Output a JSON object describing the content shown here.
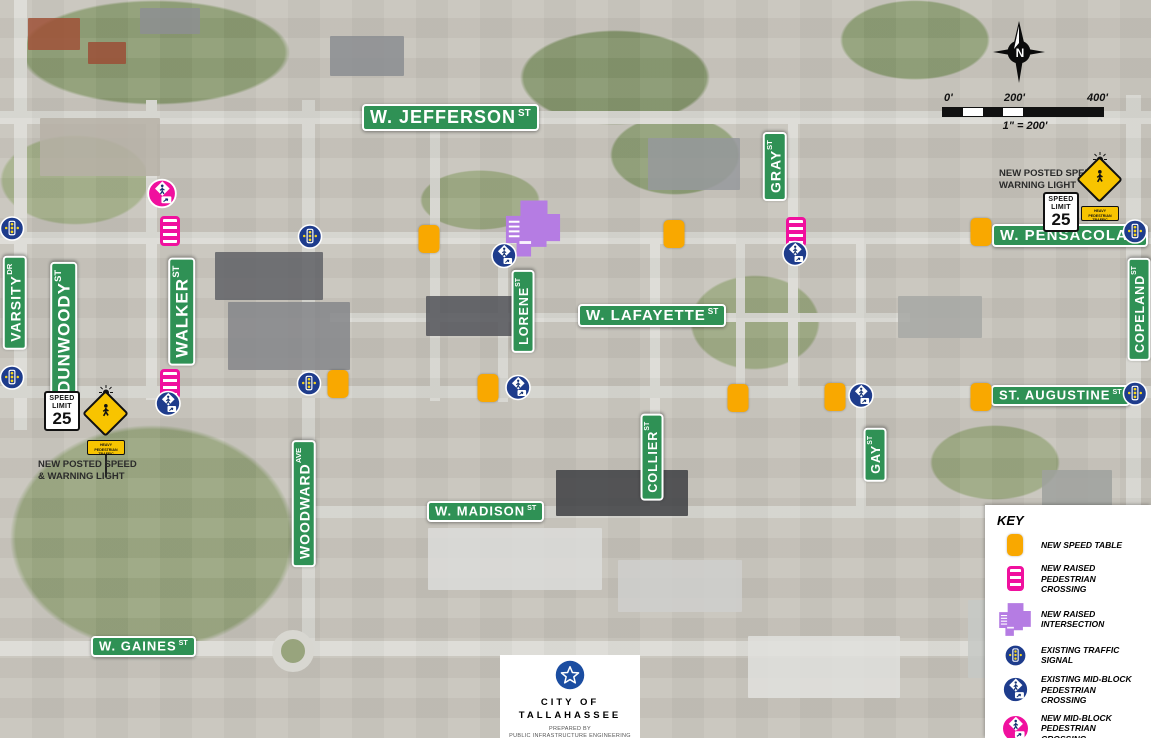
{
  "compass": {
    "label": "N"
  },
  "scale": {
    "t0": "0'",
    "t200": "200'",
    "t400": "400'",
    "ratio": "1\" = 200'"
  },
  "notes": {
    "left1": "NEW POSTED SPEED",
    "left2": "& WARNING LIGHT",
    "right1": "NEW POSTED SPEED &",
    "right2": "WARNING LIGHT"
  },
  "speed_sign": {
    "word1": "SPEED",
    "word2": "LIMIT",
    "value": "25"
  },
  "ped_sign_plaque": "HEAVY PEDESTRIAN TRAFFIC",
  "legend": {
    "title": "KEY",
    "items": [
      {
        "icon": "speed-table",
        "label": "NEW SPEED TABLE"
      },
      {
        "icon": "raised-crossing",
        "label": "NEW RAISED PEDESTRIAN CROSSING"
      },
      {
        "icon": "raised-intersection",
        "label": "NEW RAISED INTERSECTION"
      },
      {
        "icon": "traffic-signal",
        "label": "EXISTING TRAFFIC SIGNAL"
      },
      {
        "icon": "midblock-existing",
        "label": "EXISTING MID-BLOCK PEDESTRIAN CROSSING"
      },
      {
        "icon": "midblock-new",
        "label": "NEW MID-BLOCK PEDESTRIAN CROSSING"
      }
    ]
  },
  "footer": {
    "city1": "CITY OF",
    "city2": "TALLAHASSEE",
    "prepared": "PREPARED BY",
    "org": "PUBLIC INFRASTRUCTURE ENGINEERING"
  },
  "colors": {
    "street_green": "#2f9155",
    "speed_table": "#f9a800",
    "new_magenta": "#f0109e",
    "raised_purple": "#b57ce3",
    "existing_blue": "#1e3c8c",
    "figure_navy": "#123070",
    "signal_dot": "#f7d51d"
  },
  "map": {
    "streets": [
      {
        "label": "W. JEFFERSON",
        "suffix": "ST",
        "x": 362,
        "y": 104,
        "size": "lg",
        "vert": false
      },
      {
        "label": "W. PENSACOLA",
        "suffix": "ST",
        "x": 992,
        "y": 224,
        "size": "md",
        "vert": false
      },
      {
        "label": "W. LAFAYETTE",
        "suffix": "ST",
        "x": 578,
        "y": 304,
        "size": "md",
        "vert": false
      },
      {
        "label": "ST. AUGUSTINE",
        "suffix": "ST",
        "x": 991,
        "y": 385,
        "size": "sm",
        "vert": false
      },
      {
        "label": "W. MADISON",
        "suffix": "ST",
        "x": 427,
        "y": 501,
        "size": "sm",
        "vert": false
      },
      {
        "label": "W. GAINES",
        "suffix": "ST",
        "x": 91,
        "y": 636,
        "size": "sm",
        "vert": false
      },
      {
        "label": "VARSITY",
        "suffix": "DR",
        "x": 3,
        "y": 256,
        "size": "vmd",
        "vert": true
      },
      {
        "label": "DUNWOODY",
        "suffix": "ST",
        "x": 50,
        "y": 262,
        "size": "vlg",
        "vert": true
      },
      {
        "label": "WALKER",
        "suffix": "ST",
        "x": 168,
        "y": 258,
        "size": "vlg",
        "vert": true
      },
      {
        "label": "GRAY",
        "suffix": "ST",
        "x": 763,
        "y": 132,
        "size": "vmd",
        "vert": true
      },
      {
        "label": "LORENE",
        "suffix": "ST",
        "x": 512,
        "y": 270,
        "size": "vsm",
        "vert": true
      },
      {
        "label": "WOODWARD",
        "suffix": "AVE",
        "x": 292,
        "y": 440,
        "size": "vmd",
        "vert": true
      },
      {
        "label": "COLLIER",
        "suffix": "ST",
        "x": 641,
        "y": 414,
        "size": "vsm",
        "vert": true
      },
      {
        "label": "GAY",
        "suffix": "ST",
        "x": 864,
        "y": 428,
        "size": "vsm",
        "vert": true
      },
      {
        "label": "COPELAND",
        "suffix": "ST",
        "x": 1128,
        "y": 258,
        "size": "vsm",
        "vert": true
      }
    ],
    "markers": [
      {
        "t": "raised-intersection",
        "x": 533,
        "y": 231
      },
      {
        "t": "speed-table",
        "x": 429,
        "y": 239
      },
      {
        "t": "speed-table",
        "x": 674,
        "y": 234
      },
      {
        "t": "speed-table",
        "x": 981,
        "y": 232
      },
      {
        "t": "speed-table",
        "x": 338,
        "y": 384
      },
      {
        "t": "speed-table",
        "x": 488,
        "y": 388
      },
      {
        "t": "speed-table",
        "x": 738,
        "y": 398
      },
      {
        "t": "speed-table",
        "x": 835,
        "y": 397
      },
      {
        "t": "speed-table",
        "x": 981,
        "y": 397
      },
      {
        "t": "raised-crossing",
        "x": 170,
        "y": 231
      },
      {
        "t": "raised-crossing",
        "x": 170,
        "y": 384
      },
      {
        "t": "raised-crossing",
        "x": 796,
        "y": 232
      },
      {
        "t": "traffic-signal",
        "x": 12,
        "y": 231
      },
      {
        "t": "traffic-signal",
        "x": 12,
        "y": 380
      },
      {
        "t": "traffic-signal",
        "x": 310,
        "y": 239
      },
      {
        "t": "traffic-signal",
        "x": 309,
        "y": 386
      },
      {
        "t": "traffic-signal",
        "x": 1135,
        "y": 234
      },
      {
        "t": "traffic-signal",
        "x": 1135,
        "y": 396
      },
      {
        "t": "midblock-existing",
        "x": 168,
        "y": 406
      },
      {
        "t": "midblock-existing",
        "x": 504,
        "y": 258
      },
      {
        "t": "midblock-existing",
        "x": 795,
        "y": 256
      },
      {
        "t": "midblock-existing",
        "x": 518,
        "y": 390
      },
      {
        "t": "midblock-existing",
        "x": 861,
        "y": 398
      },
      {
        "t": "midblock-new",
        "x": 162,
        "y": 196
      }
    ]
  }
}
